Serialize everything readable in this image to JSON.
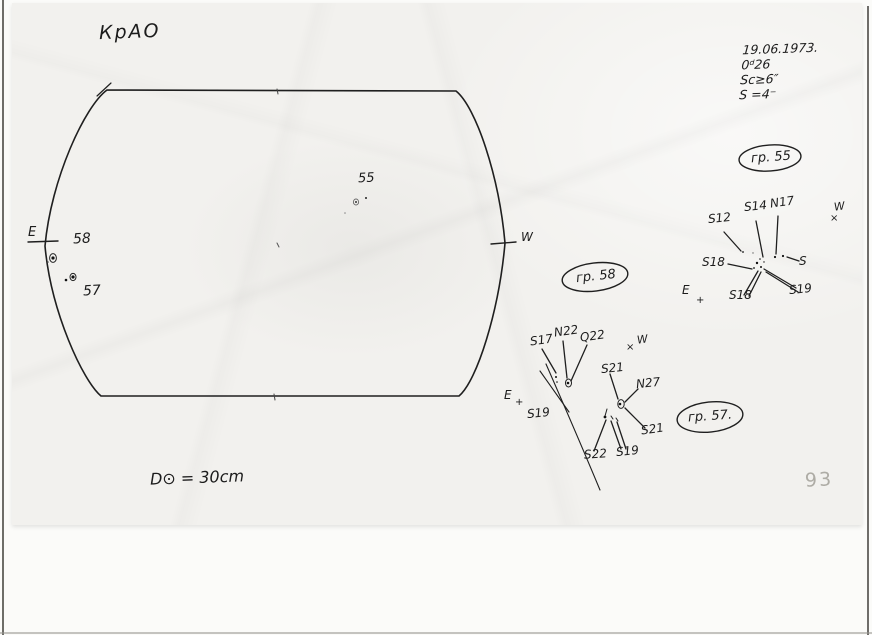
{
  "observatory": "КрАО",
  "page_number": "93",
  "observation_info": {
    "date": "19.06.1973.",
    "time_note": "0ᵈ26",
    "seeing": "Sc≥6″",
    "s_value": "S =4⁻"
  },
  "instrument": {
    "aperture": "D⊙ = 30cm"
  },
  "disk": {
    "east": "E",
    "west": "W",
    "group_58": "58",
    "group_57": "57",
    "group_55": "55"
  },
  "group55": {
    "title": "гр. 55",
    "west": "W",
    "west_mark": "×",
    "east": "E",
    "east_mark": "+",
    "labels": {
      "s12": "S12",
      "s14": "S14",
      "n17": "N17",
      "s18_left": "S18",
      "s_right": "S",
      "s18_bottom": "S18",
      "s19": "S19"
    }
  },
  "group58": {
    "title": "гр. 58",
    "east": "E",
    "east_mark": "+",
    "labels": {
      "s17": "S17",
      "n22": "N22",
      "q22": "Q22",
      "s19_left": "S19"
    }
  },
  "group57": {
    "title": "гр. 57.",
    "west": "W",
    "west_mark": "×",
    "labels": {
      "s21_top": "S21",
      "n27": "N27",
      "s21_right": "S21",
      "s22": "S22",
      "s19_bottom": "S19"
    }
  }
}
